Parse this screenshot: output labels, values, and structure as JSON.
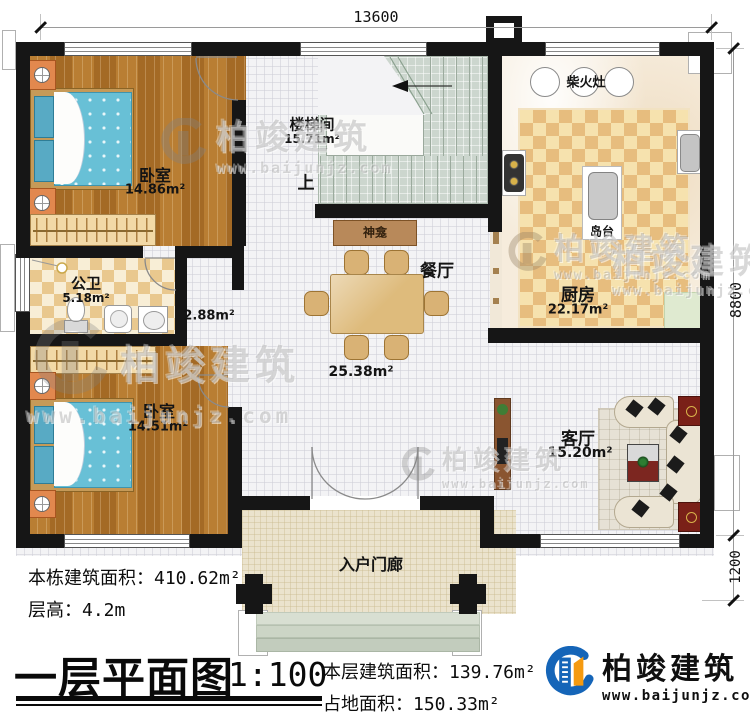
{
  "dims": {
    "top": "13600",
    "side": "8800",
    "porch": "1200"
  },
  "rooms": {
    "bedroom1": {
      "name": "卧室",
      "area": "14.86m²"
    },
    "bedroom2": {
      "name": "卧室",
      "area": "14.51m²"
    },
    "stair": {
      "name": "楼梯间",
      "area": "15.71m²",
      "up": "上"
    },
    "bath": {
      "name": "公卫",
      "area": "5.18m²"
    },
    "corridor": {
      "area": "2.88m²"
    },
    "dining": {
      "name": "餐厅",
      "area": "25.38m²"
    },
    "shrine": {
      "name": "神龛"
    },
    "stove": {
      "name": "柴火灶"
    },
    "island": {
      "name": "岛台"
    },
    "kitchen": {
      "name": "厨房",
      "area": "22.17m²"
    },
    "living": {
      "name": "客厅",
      "area": "15.20m²"
    },
    "porch": {
      "name": "入户门廊"
    }
  },
  "stats": {
    "building_label": "本栋建筑面积：",
    "building_value": "410.62m²",
    "height_label": "层高：",
    "height_value": "4.2m",
    "floor_label": "本层建筑面积：",
    "floor_value": "139.76m²",
    "footprint_label": "占地面积：",
    "footprint_value": "150.33m²"
  },
  "footer": {
    "title": "一层平面图",
    "scale": "1:100"
  },
  "brand": {
    "name": "柏竣建筑",
    "site": "www.baijunjz.com"
  },
  "watermark": {
    "name": "柏竣建筑",
    "site": "www.baijunjz.com"
  },
  "colors": {
    "wall": "#161616",
    "brand_blue": "#1565b8",
    "brand_orange": "#f59a10",
    "wood_floor": "#ad742c",
    "bed_blue": "#68c0d6",
    "sofa_cream": "#ebe4d4",
    "accent_maroon": "#7a2018",
    "stair_sage": "#ccd6ce"
  }
}
